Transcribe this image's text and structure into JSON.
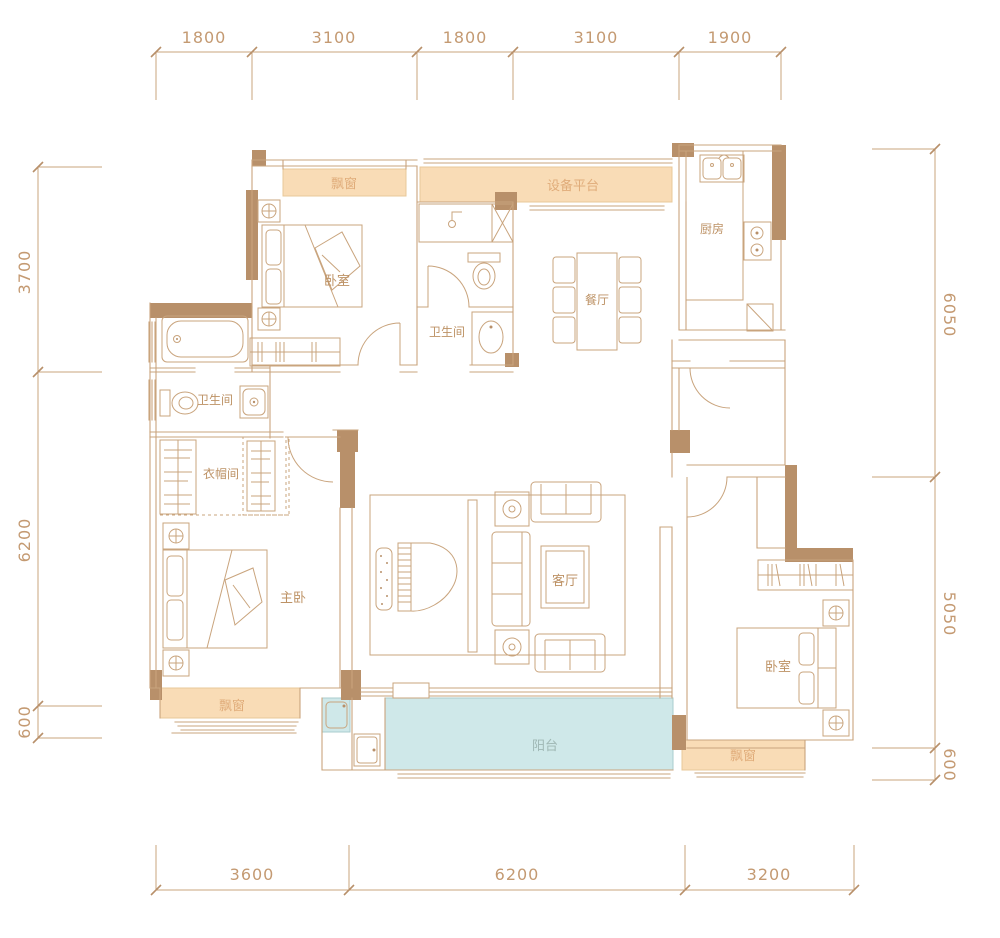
{
  "plan": {
    "rooms": {
      "bedroom_top": "卧室",
      "bathroom_top": "卫生间",
      "dining": "餐厅",
      "kitchen": "厨房",
      "equipment_platform": "设备平台",
      "bathroom_master": "卫生间",
      "cloakroom": "衣帽间",
      "master_bedroom": "主卧",
      "living_room": "客厅",
      "bedroom_right": "卧室",
      "balcony": "阳台",
      "bay_window_top": "飘窗",
      "bay_window_master": "飘窗",
      "bay_window_right": "飘窗"
    },
    "dimensions": {
      "top": [
        "1800",
        "3100",
        "1800",
        "3100",
        "1900"
      ],
      "bottom": [
        "3600",
        "6200",
        "3200"
      ],
      "left": [
        "3700",
        "6200",
        "600"
      ],
      "right": [
        "6050",
        "5050",
        "600"
      ]
    },
    "colors": {
      "wall_solid": "#b8906a",
      "wall_line": "#c9a47d",
      "bay_window_fill": "#f9dcb6",
      "balcony_fill": "#cfe8e9",
      "dimension_text": "#c49a72",
      "room_text": "#bd9265",
      "background": "#ffffff"
    }
  }
}
